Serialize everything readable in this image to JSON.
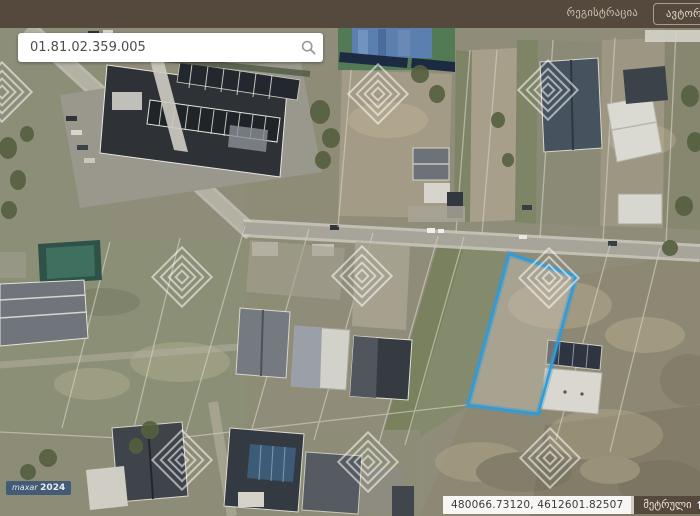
{
  "topbar": {
    "registration_label": "რეგისტრაცია",
    "authorization_label": "ავტორიზაცია",
    "background_color": "#55493d"
  },
  "search": {
    "value": "01.81.02.359.005",
    "icon": "search-icon"
  },
  "map": {
    "type": "satellite-cadastral-imagery",
    "highlighted_parcel_color": "#2f9bd8",
    "watermark_icon": "diamond-watermark",
    "imagery_watermark_text": "maxar",
    "imagery_watermark_year": "2024"
  },
  "statusbar": {
    "coordinates": "480066.73120, 4612601.82507",
    "unit_label": "მეტრული",
    "sort_icon_char": "⇅",
    "scale_label": "მასშტაბი"
  }
}
